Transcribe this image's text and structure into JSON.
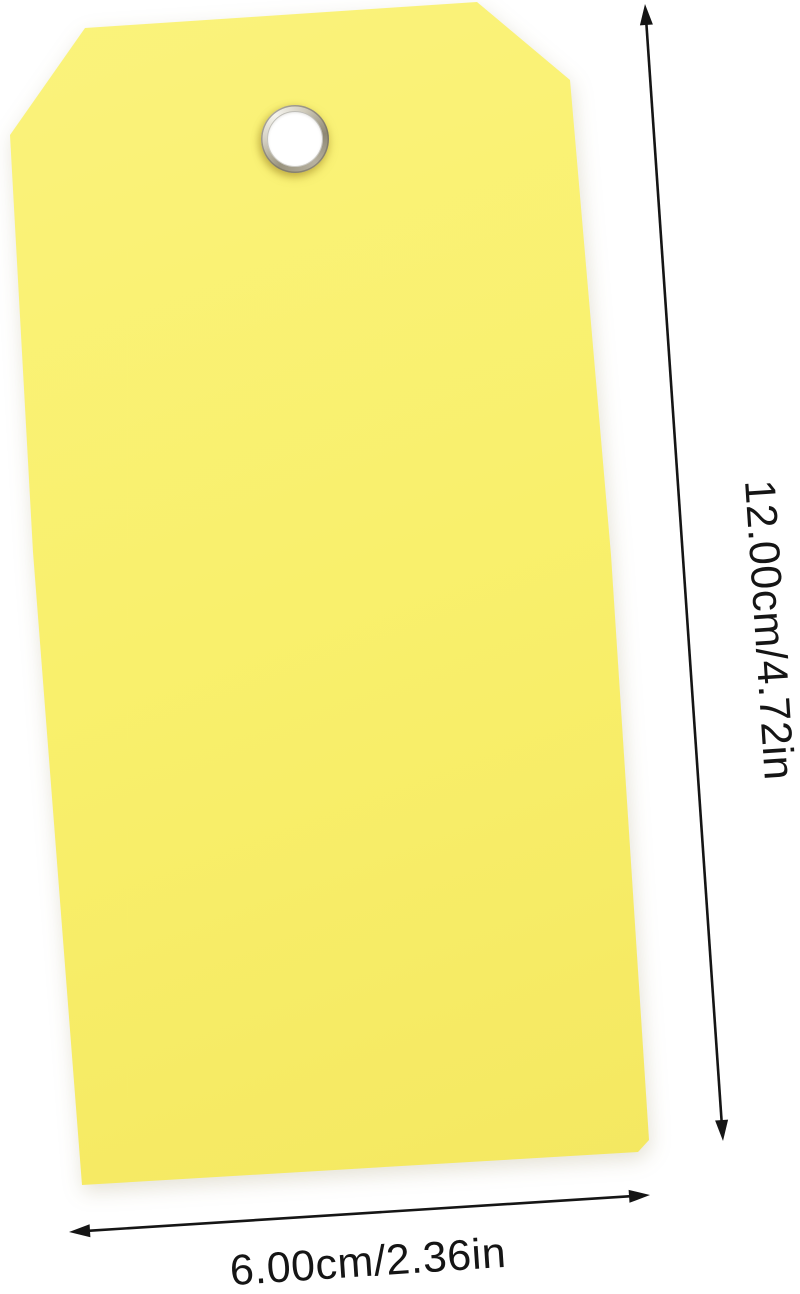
{
  "colors": {
    "background": "#ffffff",
    "tag-yellow": "#f9f06c",
    "tag-yellow-light": "#faf37c",
    "tag-yellow-dark": "#f3e65e",
    "annotation": "#151515",
    "grommet-silver": "#cfcaba",
    "grommet-hole": "#ffffff"
  },
  "labels": {
    "height": "12.00cm/4.72in",
    "width": "6.00cm/2.36in"
  },
  "icons": {
    "vertical_arrow": "double-headed-arrow-vertical",
    "horizontal_arrow": "double-headed-arrow-horizontal"
  }
}
